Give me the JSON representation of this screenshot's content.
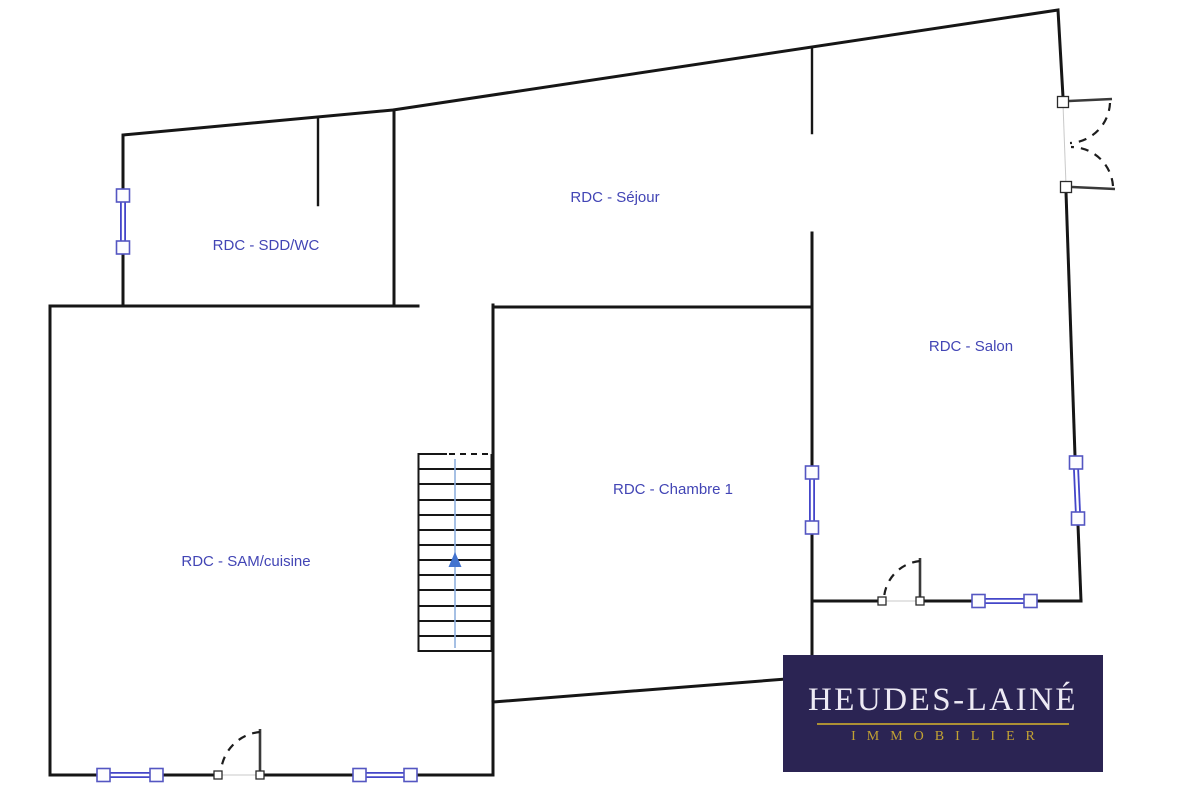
{
  "floorplan": {
    "floor_code": "RDC",
    "rooms": [
      {
        "id": "sdd-wc",
        "label": "RDC - SDD/WC"
      },
      {
        "id": "sejour",
        "label": "RDC - Séjour"
      },
      {
        "id": "salon",
        "label": "RDC - Salon"
      },
      {
        "id": "chambre-1",
        "label": "RDC - Chambre 1"
      },
      {
        "id": "sam-cuisine",
        "label": "RDC - SAM/cuisine"
      }
    ],
    "colors": {
      "wall": "#161616",
      "window": "#4446c9",
      "window_frame": "#5456c2",
      "room_label": "#4245b5",
      "stair_direction_line": "#8fb0de",
      "stair_arrow": "#4273cf"
    },
    "symbols": {
      "windows_count": 6,
      "door_swings_count": 3,
      "staircase": "up"
    }
  },
  "logo": {
    "name": "HEUDES-LAINÉ",
    "tagline": "IMMOBILIER",
    "colors": {
      "background": "#2b2453",
      "name": "#edeaf4",
      "tagline": "#c2a233",
      "rule": "#ac9035"
    }
  }
}
